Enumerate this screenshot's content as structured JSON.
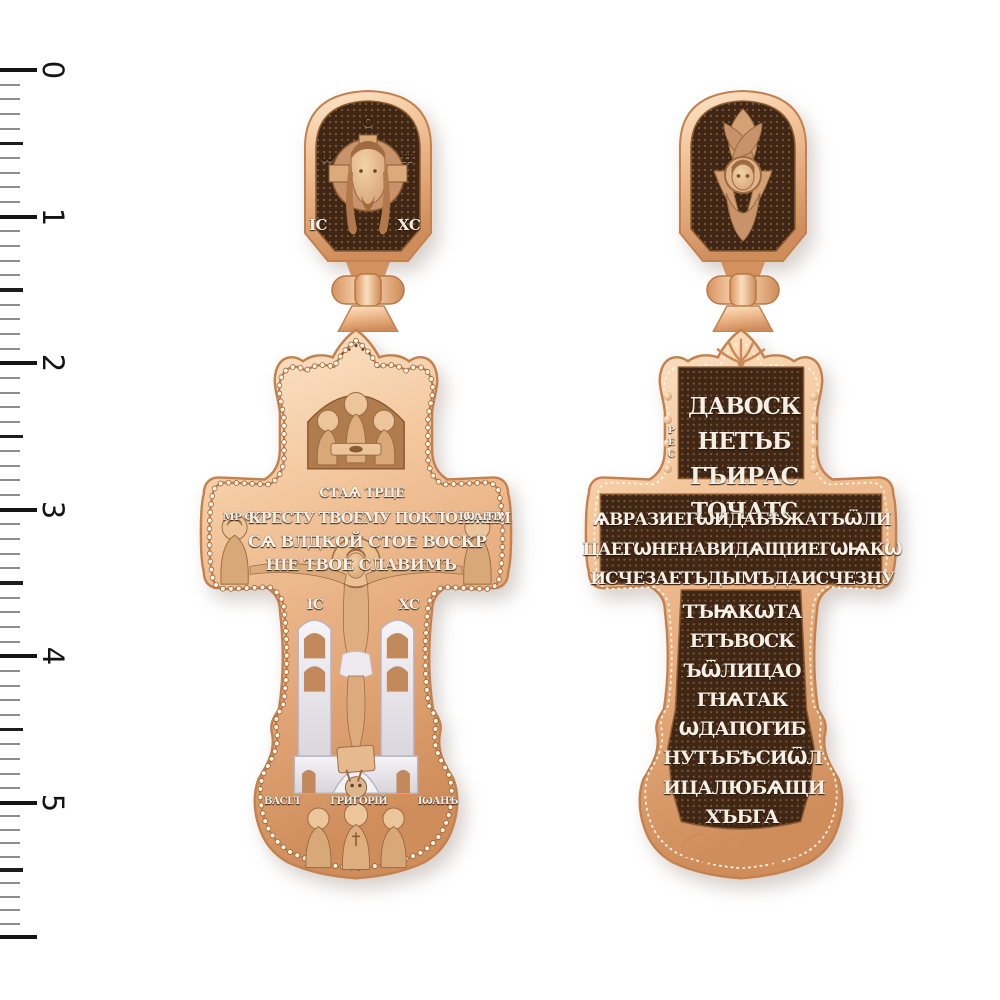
{
  "page": {
    "background": "#ffffff",
    "subject": "orthodox-cross-pendant-front-and-back"
  },
  "ruler": {
    "labels": [
      "0",
      "1",
      "2",
      "3",
      "4",
      "5"
    ]
  },
  "front_pendant": {
    "bail": {
      "icon": "holy-face-icon",
      "nimbus_letters": {
        "left": "Ѡ",
        "top": "О",
        "right": "Н"
      },
      "christogram_left": "ІС",
      "christogram_right": "ХС"
    },
    "top_icon": "holy-trinity-icon",
    "trinity_caption": "СТАѦ ТРЦЕ",
    "crossbar": {
      "left_figure_icon": "theotokos-icon",
      "left_label": "МР ѲУ",
      "lines": [
        "КРЕСТУ ТВОЕМУ ПОКЛОНѦЕМ",
        "СѦ ВЛДКОЙ СТОЕ ВОСКР",
        "НІЕ ТВОЕ СЛАВИМЪ"
      ],
      "right_figure_icon": "john-theologian-icon",
      "right_label": "ІѠАНЪ"
    },
    "center": {
      "icon": "crucifixion-icon",
      "christogram_left": "ІС",
      "christogram_right": "ХС",
      "backdrop_icon": "church-icon",
      "golgotha_icon": "adam-skull-icon"
    },
    "bottom": {
      "icon": "three-hierarchs-icon",
      "saint_labels": [
        "ВАСІЛ",
        "ГРИГОРІЙ",
        "ІѠАНЪ"
      ]
    }
  },
  "back_pendant": {
    "bail": {
      "icon": "seraphim-icon"
    },
    "prayer": {
      "top_lines": [
        "ДАВОСК",
        "НЕТЪБ",
        "ГЪИРАС",
        "ТОЧАТС"
      ],
      "top_side_small": "РЕС",
      "bar_lines": [
        "ѦВРАЗИЕГѠИДАБѢЖАТЪѾЛИ",
        "ЦАЕГѠНЕНАВИДѦЩІИЕГѠѨКѠ",
        "ИСЧЕЗАЕТЪДЫМЪДАИСЧЕЗНУ"
      ],
      "bottom_lines": [
        "ТЪѨКѠТА",
        "ЕТЪВОСК",
        "ЪѾЛИЦАО",
        "ГНѦТАК",
        "ѠДАПОГИБ",
        "НУТЪБѢСИѾЛ",
        "ИЦАЛЮБѦЩИ",
        "ХЪБГА"
      ]
    },
    "ornaments": [
      "palmette-ornament",
      "scroll-ornament"
    ]
  },
  "colors": {
    "gold_light": "#fbe4c8",
    "gold_mid": "#eeb488",
    "gold_deep": "#d18f5d",
    "panel_dark": "#3f2615",
    "silver": "#e9e7ec",
    "relief_text": "#f4efe4",
    "ruler_major": "#141414",
    "ruler_minor": "#8d8d8d"
  }
}
